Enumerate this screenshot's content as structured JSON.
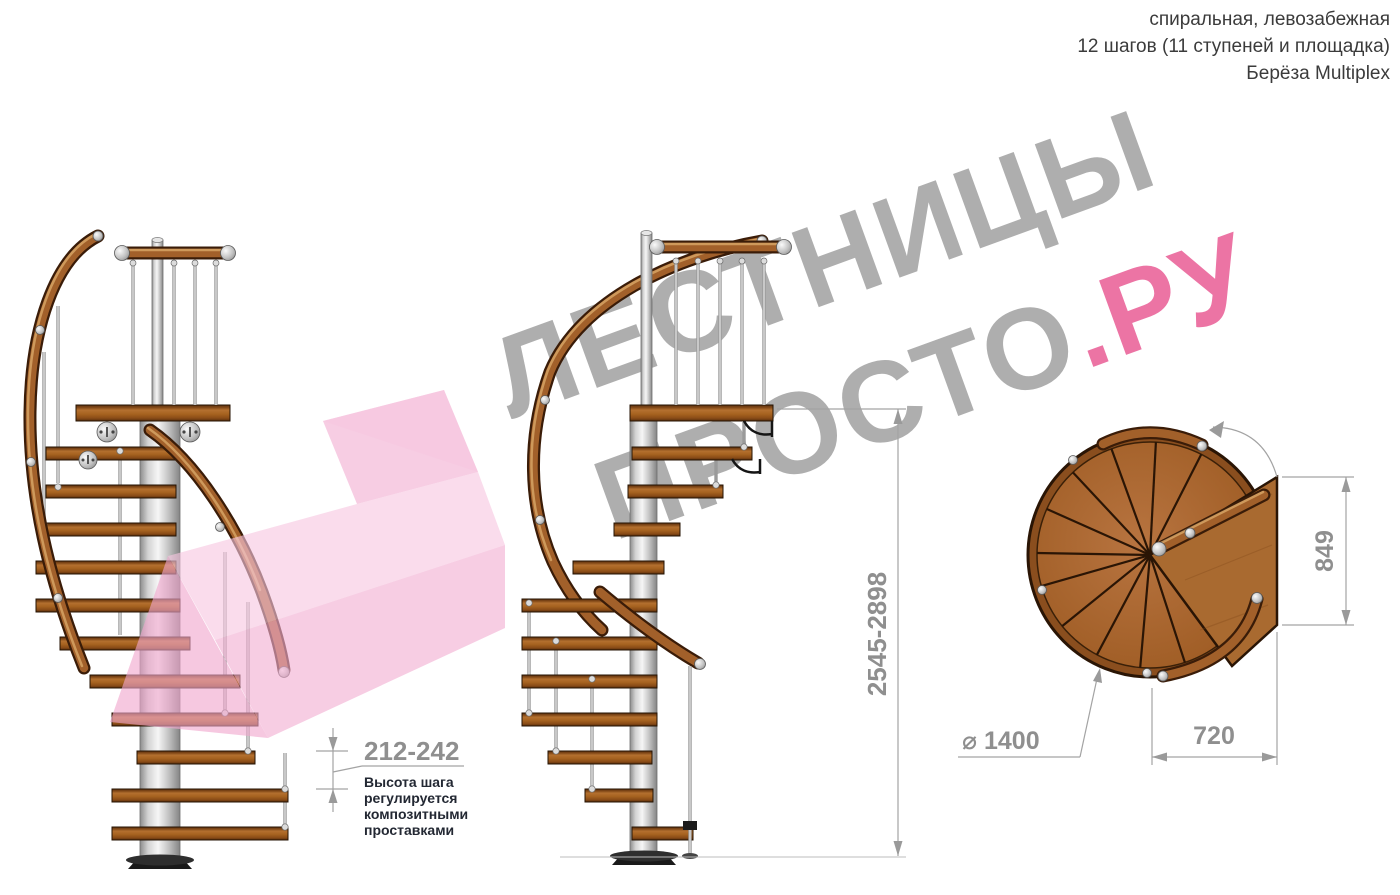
{
  "header": {
    "lines": [
      "спиральная, левозабежная",
      "12 шагов (11 ступеней и площадка)",
      "Берёза Multiplex"
    ]
  },
  "watermark": {
    "line1": "ЛЕСТНИЦЫ",
    "line2_gray": "ПРОСТО",
    "line2_accent": ".РУ",
    "gray_color": "#aeaeae",
    "accent_color": "#ec74a4"
  },
  "dimensions": {
    "step_height": "212-242",
    "step_height_note": "Высота шага регулируется композитными проставками",
    "total_height": "2545-2898",
    "platform_depth": "849",
    "platform_width": "720",
    "diameter": "⌀ 1400"
  },
  "colors": {
    "wood_mid": "#a2602a",
    "wood_outline": "#2a1505",
    "pole_metal": "#d9d9d9",
    "dimension_gray": "#8f8f8f",
    "note_text": "#232833",
    "arrow_pink": "#f2aed2"
  }
}
